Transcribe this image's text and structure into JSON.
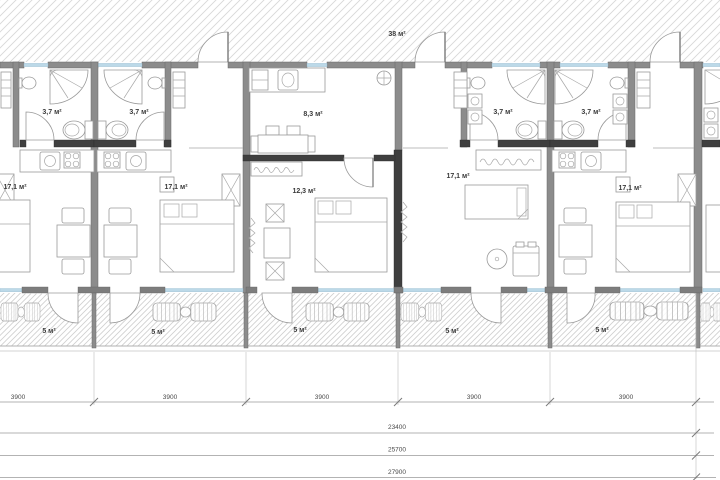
{
  "drawing": {
    "terrace": {
      "area": "38 м²"
    },
    "bathrooms": [
      {
        "area": "3,7 м²"
      },
      {
        "area": "3,7 м²"
      },
      {
        "area": "3,7 м²"
      },
      {
        "area": "3,7 м²"
      }
    ],
    "kitchen": {
      "area": "8,3 м²"
    },
    "bedroom": {
      "area": "12,3 м²"
    },
    "living_rooms": [
      {
        "area": "17,1 м²"
      },
      {
        "area": "17,1 м²"
      },
      {
        "area": "17,1 м²"
      },
      {
        "area": "17,1 м²"
      }
    ],
    "balconies": [
      {
        "area": "5 м²"
      },
      {
        "area": "5 м²"
      },
      {
        "area": "5 м²"
      },
      {
        "area": "5 м²"
      },
      {
        "area": "5 м²"
      }
    ],
    "dimensions": {
      "modules": [
        "3900",
        "3900",
        "3900",
        "3900",
        "3900"
      ],
      "totals": [
        "23400",
        "25700",
        "27900"
      ]
    },
    "colors": {
      "wall": "#8c8c8c",
      "wall_dark": "#3f3f3f",
      "window": "#bcd9e8",
      "hatch": "#d8d8d8",
      "furniture": "#9a9a9a",
      "text": "#3a3a3a"
    }
  }
}
